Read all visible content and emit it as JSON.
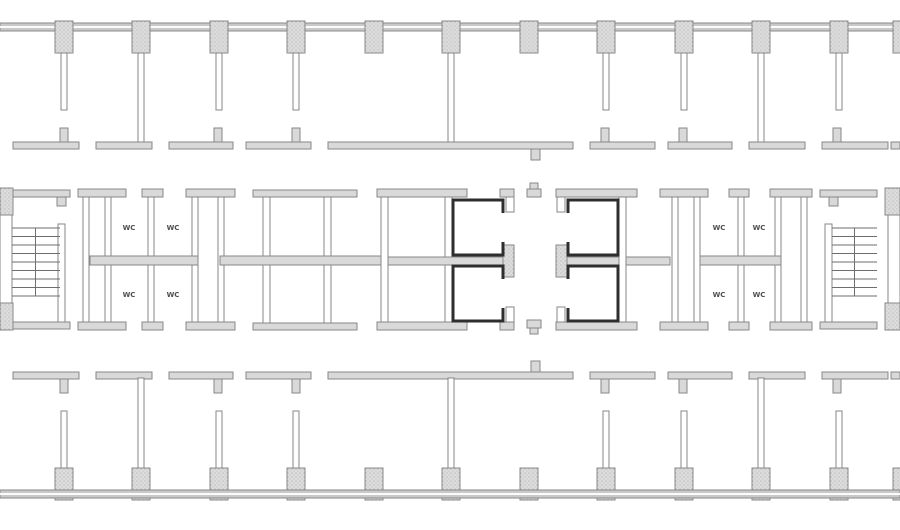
{
  "wc_rooms": {
    "left": [
      "WC",
      "WC",
      "WC",
      "WC"
    ],
    "right": [
      "WC",
      "WC",
      "WC",
      "WC"
    ]
  },
  "colors": {
    "background": "#ffffff",
    "wall_fill": "#d9d9d9",
    "wall_line": "#878787",
    "facade_fill": "#c9c9c9",
    "column_fill": "#dcdcdc",
    "elevator_outline": "#2e2e2e",
    "stair_tread": "#6e6e6e",
    "label_text": "#4f4f4f"
  }
}
